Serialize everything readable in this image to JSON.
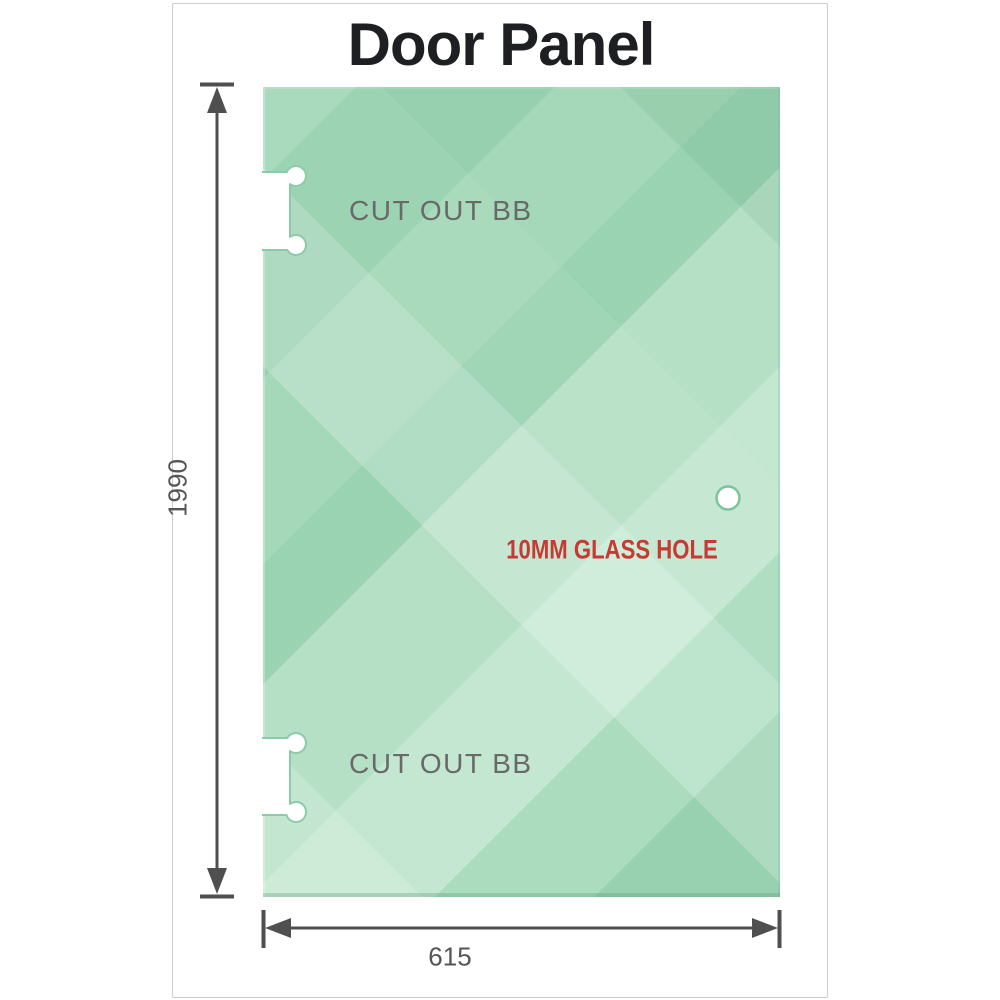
{
  "title": "Door Panel",
  "panel": {
    "cutout_top_label": "CUT OUT BB",
    "cutout_bottom_label": "CUT OUT BB",
    "glass_hole_label": "10MM GLASS HOLE"
  },
  "dimensions": {
    "height_value": "1990",
    "width_value": "615"
  },
  "colors": {
    "glass_green": "#96d0ae",
    "glass_highlight": "#c3e7d0",
    "glass_edge": "#8ccbaa",
    "dimension_gray": "#4f4f4f",
    "hole_label_red": "#c53b33",
    "cutout_label_gray": "#696969",
    "title_color": "#1d1f22",
    "card_border": "#cccccc"
  }
}
